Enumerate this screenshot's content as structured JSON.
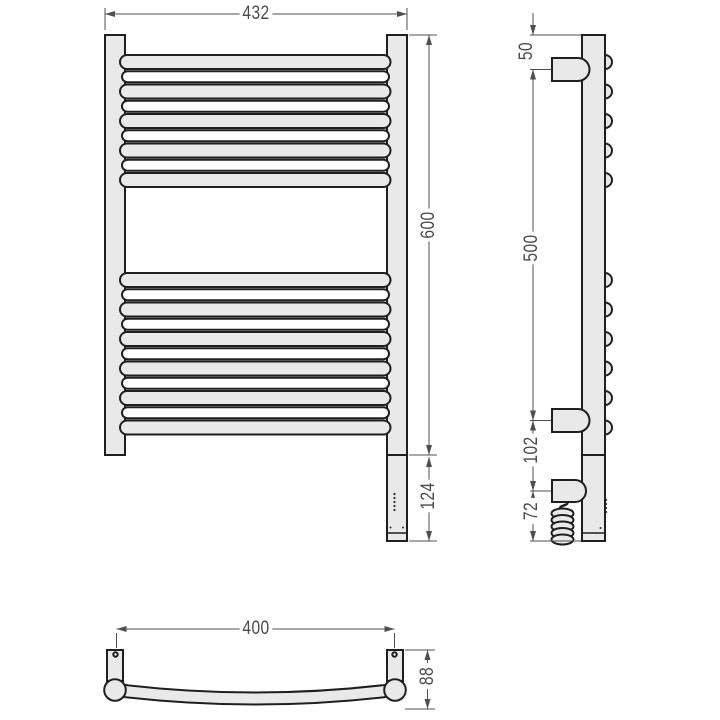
{
  "drawing": {
    "type": "technical-dimension-drawing",
    "subject": "ladder towel rail with electric heating element, three orthographic views",
    "colors": {
      "background": "#ffffff",
      "outline": "#1f1f1f",
      "metal_fill": "#e9e9e9",
      "rear_bar_fill": "#ffffff",
      "dimension": "#4f4f4f"
    }
  },
  "views": {
    "front": {
      "name": "front view",
      "dims": {
        "width": "432",
        "height": "600",
        "heater": "124"
      }
    },
    "side": {
      "name": "side view",
      "dims": {
        "top_offset": "50",
        "bracket_span": "500",
        "heater_offset": "102",
        "bottom_offset": "72"
      }
    },
    "top": {
      "name": "top view",
      "dims": {
        "mount_span": "400",
        "depth": "88"
      }
    }
  }
}
